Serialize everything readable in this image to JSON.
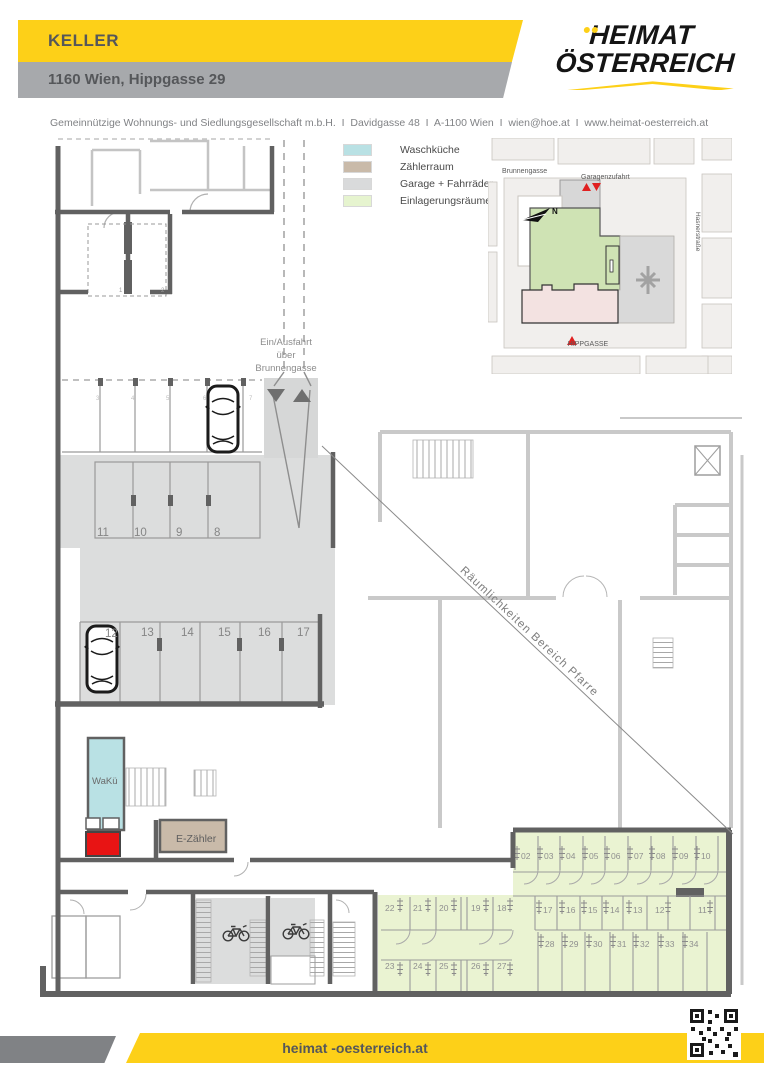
{
  "header": {
    "title": "KELLER",
    "subtitle": "1160 Wien, Hippgasse 29",
    "contact_line": "Gemeinnützige Wohnungs- und Siedlungsgesellschaft m.b.H.  I  Davidgasse 48  I  A-1100 Wien  I  wien@hoe.at  I  www.heimat-oesterreich.at",
    "logo": {
      "line1": "HEIMAT",
      "line2": "ÖSTERREICH"
    }
  },
  "legend": {
    "items": [
      {
        "label": "Waschküche",
        "color": "#b9e1e4"
      },
      {
        "label": "Zählerraum",
        "color": "#c9baa9"
      },
      {
        "label": "Garage + Fahrräder",
        "color": "#d9dadb"
      },
      {
        "label": "Einlagerungsräume",
        "color": "#e6f4cf"
      }
    ]
  },
  "site_map": {
    "street_top": "Brunnengasse",
    "garage_entry": "Garagenzufahrt",
    "street_right": "Hasnerstraße",
    "street_bottom": "HIPPGASSE",
    "north_label": "N"
  },
  "plan": {
    "ramp_label_lines": [
      "Ein/Ausfahrt",
      "über",
      "Brunnengasse"
    ],
    "wakue_label": "WaKü",
    "ezaehler_label": "E-Zähler",
    "diagonal_label": "Räumlichkeiten Bereich Pfarre",
    "upper_parking": [
      "3",
      "4",
      "5",
      "6",
      "7"
    ],
    "room_numbers": [
      "1",
      "2"
    ],
    "parking_row_a": [
      "11",
      "10",
      "9",
      "8"
    ],
    "parking_row_b": [
      "12",
      "13",
      "14",
      "15",
      "16",
      "17"
    ],
    "storage_right_top": [
      "02",
      "03",
      "04",
      "05",
      "06",
      "07",
      "08",
      "09",
      "10"
    ],
    "storage_right_mid": [
      "17",
      "16",
      "15",
      "14",
      "13",
      "12",
      "11"
    ],
    "storage_right_bottom": [
      "28",
      "29",
      "30",
      "31",
      "32",
      "33",
      "34"
    ],
    "storage_left_top": [
      "22",
      "21",
      "20",
      "19",
      "18"
    ],
    "storage_left_bottom": [
      "23",
      "24",
      "25",
      "26",
      "27"
    ]
  },
  "footer": {
    "website": "heimat -oesterreich.at"
  },
  "colors": {
    "brand_yellow": "#fdd018",
    "bar_gray": "#a7a9ac",
    "wall_dark": "#616161",
    "wall_light": "#c9c9c9",
    "fill_garage": "#dcdddd",
    "fill_storage": "#eaf3d2",
    "fill_waschkueche": "#b9e1e4",
    "fill_zaehlerraum": "#c9baa9",
    "accent_red": "#e81414"
  }
}
